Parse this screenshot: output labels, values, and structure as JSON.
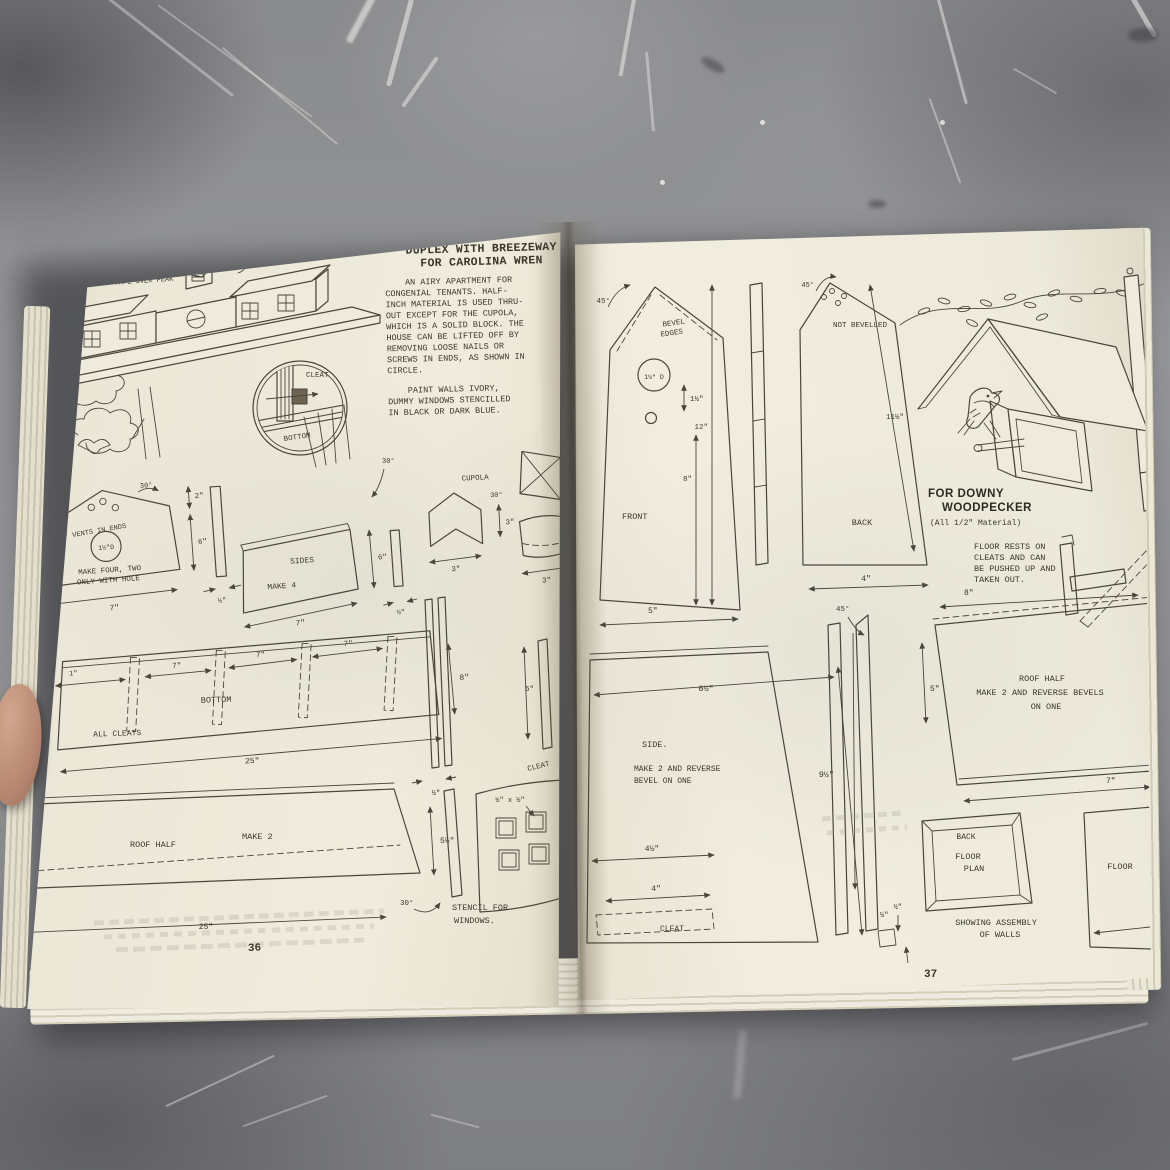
{
  "colors": {
    "page_cream": "#efebdc",
    "ink": "#4b463c",
    "concrete_gray": "#8e8f91",
    "thumb_skin": "#b3846e"
  },
  "left_page": {
    "page_number": "36",
    "roof_caption": [
      "PAINT ROOF GREEN",
      "AFTER LAYING ADHESIVE",
      "TAPE OVER PEAK"
    ],
    "title": [
      "DUPLEX WITH BREEZEWAY",
      "FOR CAROLINA WREN"
    ],
    "intro": [
      "AN AIRY APARTMENT FOR",
      "CONGENIAL TENANTS.  HALF-",
      "INCH MATERIAL IS USED THRU-",
      "OUT EXCEPT FOR THE CUPOLA,",
      "WHICH IS A SOLID BLOCK.  THE",
      "HOUSE CAN BE LIFTED OFF BY",
      "REMOVING LOOSE NAILS OR",
      "SCREWS IN ENDS, AS SHOWN IN",
      "CIRCLE."
    ],
    "paint_note": [
      "PAINT WALLS IVORY,",
      "DUMMY WINDOWS STENCILLED",
      "IN BLACK OR DARK BLUE."
    ],
    "inset": {
      "cleat": "CLEAT",
      "bottom": "BOTTOM"
    },
    "end_piece": {
      "vents": "½\" VENTS IN ENDS",
      "hole_d": "1½\"D",
      "make": [
        "MAKE FOUR, TWO",
        "ONLY WITH HOLE"
      ],
      "angle": "30°",
      "d_top": "2\"",
      "d_side": "6\"",
      "d_width": "7\"",
      "d_strip": "½\""
    },
    "sides_piece": {
      "name": "SIDES",
      "make": "MAKE 4",
      "d_width": "7\"",
      "d_height": "6\"",
      "d_strip": "½\"",
      "angle": "30°"
    },
    "cupola": {
      "name": "CUPOLA",
      "angle": "30°",
      "d_width": "3\"",
      "d_height": "3\"",
      "d_depth": "3\""
    },
    "bottom_piece": {
      "name": "BOTTOM",
      "note": "ALL CLEATS",
      "d_end": "1\"",
      "d_span": "7\"",
      "d_height": "8\"",
      "d_length": "25\""
    },
    "roof_piece": {
      "name": "ROOF HALF",
      "make": "MAKE 2",
      "d_height": "5½\"",
      "d_length": "25\"",
      "angle": "30°"
    },
    "cleat_strips": {
      "d_height": "6\"",
      "d_width": "½\"",
      "name": "CLEAT",
      "d_gap": "½\""
    },
    "stencil": {
      "pane": "½\" x ½\"",
      "caption": [
        "STENCIL FOR",
        "WINDOWS."
      ]
    }
  },
  "right_page": {
    "page_number": "37",
    "front_piece": {
      "angle": "45°",
      "bevel": [
        "BEVEL",
        "EDGES"
      ],
      "hole_d": "1¼\" D",
      "d_gap": "1½\"",
      "d_total": "12\"",
      "d_body": "8\"",
      "name": "FRONT",
      "d_width": "5\""
    },
    "back_piece": {
      "angle": "45°",
      "note": "NOT BEVELLED",
      "d_height": "11½\"",
      "name": "BACK",
      "d_width": "4\""
    },
    "heading": [
      "FOR DOWNY",
      "WOODPECKER"
    ],
    "material": "(All 1/2\" Material)",
    "floor_note": [
      "FLOOR RESTS ON",
      "CLEATS AND CAN",
      "BE PUSHED UP AND",
      "TAKEN OUT."
    ],
    "d_roof_span": "8\"",
    "side_piece": {
      "d_top": "6½\"",
      "name": "SIDE.",
      "make": [
        "MAKE 2 AND REVERSE",
        "BEVEL ON ONE"
      ],
      "d_upper": "4½\"",
      "d_lower": "4\"",
      "cleat": "CLEAT",
      "d_height": "9½\"",
      "angle": "45°",
      "d_strip": "5\"",
      "d_gap": "½\""
    },
    "roof_piece": {
      "lines": [
        "ROOF HALF",
        "MAKE 2 AND REVERSE BEVELS",
        "ON ONE"
      ],
      "d_width": "7\""
    },
    "floor_plan": {
      "back": "BACK",
      "label": [
        "FLOOR",
        "PLAN"
      ],
      "d_wall": "½\"",
      "caption": [
        "SHOWING ASSEMBLY",
        "OF WALLS"
      ]
    },
    "floor_label": "FLOOR"
  }
}
